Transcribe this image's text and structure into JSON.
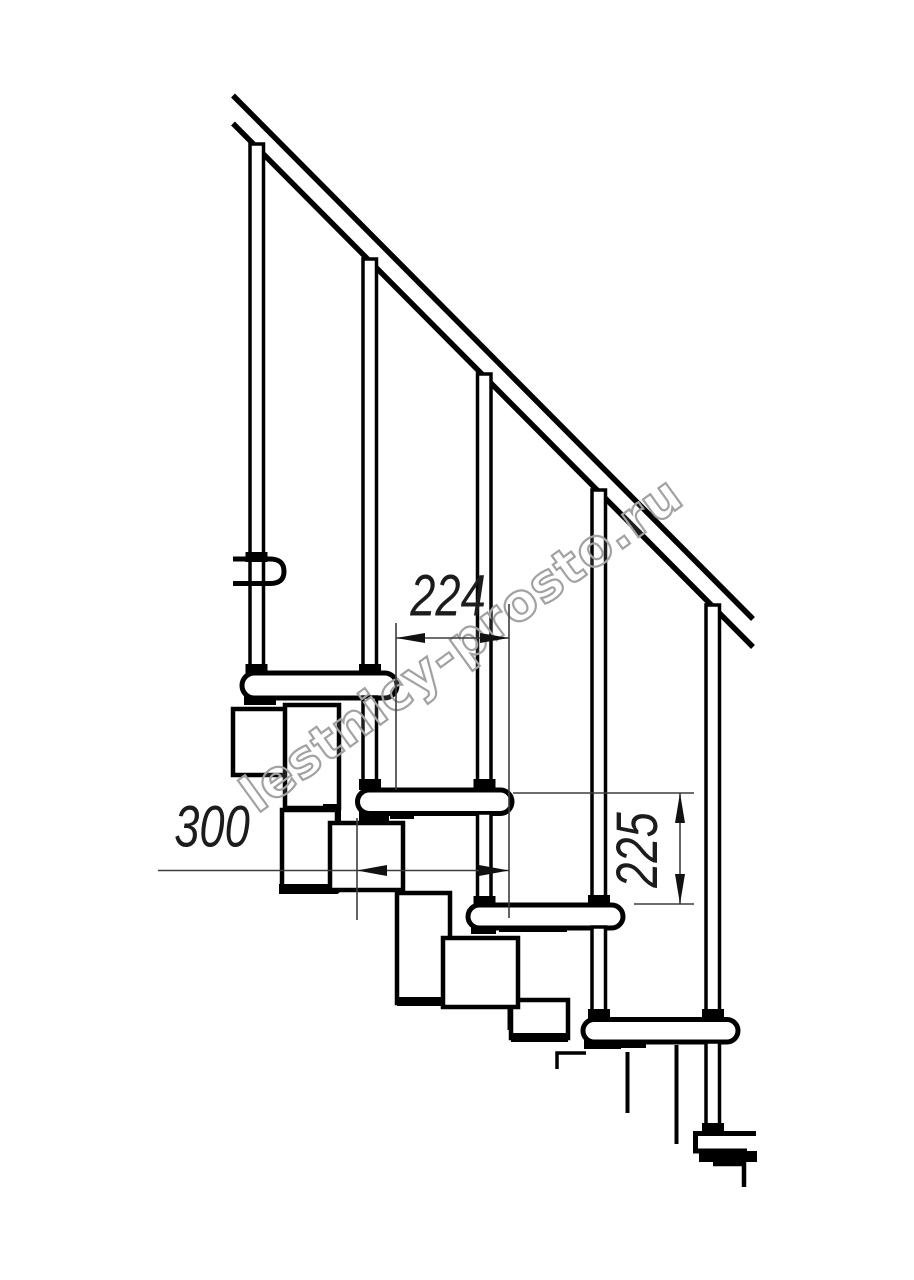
{
  "drawing": {
    "type": "staircase-side-elevation",
    "watermark": "lestnicy-prosto.ru",
    "dimensions": {
      "step_run_mm": "224",
      "tread_depth_mm": "300",
      "step_rise_mm": "225"
    },
    "colors": {
      "line": "#000000",
      "dimension_line": "#3d3d3d",
      "dimension_text": "#1c1c1c",
      "watermark_outline": "#a2a2a2",
      "background": "#ffffff"
    }
  }
}
